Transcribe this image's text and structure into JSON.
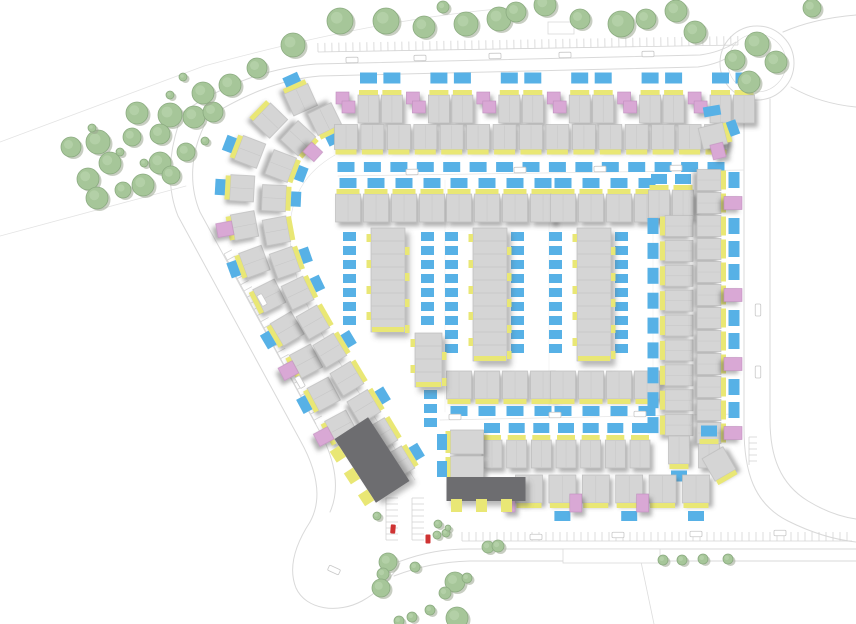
{
  "canvas": {
    "w": 856,
    "h": 624
  },
  "palette": {
    "house": "#d5d5d5",
    "houseEdge": "#bcbcbc",
    "yellow": "#e9e775",
    "blue": "#57b1e6",
    "pink": "#d9a8d5",
    "pinkEdge": "#c08fbf",
    "dark": "#6d6d6f",
    "tree": "#a6c699",
    "treeEdge": "#8bab80",
    "treeHi": "#b9d4ad",
    "treeShadow": "#9aa690",
    "road": "#d9d9d9",
    "faint": "#e6e6e6",
    "hatch": "#d4d4d4",
    "red": "#cf3333",
    "carStroke": "#c8c8c8"
  },
  "scene": {
    "roads": [
      {
        "d": "M183,112 C225,84 268,68 316,64 L700,55 C715,53 727,48 736,42"
      },
      {
        "d": "M197,124 C240,96 280,79 320,76 L698,67 C712,65 724,61 733,54"
      },
      {
        "d": "M183,112 C168,150 166,186 178,216 L300,440 C318,472 322,500 310,522"
      },
      {
        "d": "M205,124 C190,154 189,186 200,212 L320,432 C336,462 340,490 330,512"
      },
      {
        "d": "M310,522 C295,545 288,568 296,588 C306,610 338,614 362,601 C382,590 394,574 400,563"
      },
      {
        "d": "M398,562 C425,552 445,549 470,549 L856,549"
      },
      {
        "d": "M394,576 C420,566 442,562 470,561 L856,561"
      },
      {
        "d": "M744,99 L744,428 C744,472 754,504 788,521 C814,534 838,540 856,542"
      },
      {
        "d": "M770,99 L770,420 C770,456 780,484 808,501 C826,512 842,517 856,519"
      },
      {
        "d": "M783,32 C806,22 832,17 856,15"
      },
      {
        "d": "M791,87 C812,99 834,105 856,107"
      },
      {
        "d": "M0,142 L204,66",
        "w": 0.8,
        "c": "#e3e3e3"
      },
      {
        "d": "M0,236 L186,186",
        "w": 0.8,
        "c": "#e3e3e3"
      },
      {
        "d": "M204,66 C300,40 408,16 510,8",
        "w": 0.8,
        "c": "#e3e3e3"
      },
      {
        "d": "M335,155 C300,175 288,205 290,240 C292,278 310,318 338,360 L415,480",
        "w": 0.7,
        "c": "#e3e3e3"
      },
      {
        "d": "M338,176 L744,170",
        "w": 0.7,
        "c": "#e3e3e3"
      },
      {
        "d": "M440,420 L738,414",
        "w": 0.7,
        "c": "#e3e3e3"
      },
      {
        "d": "M445,180 L445,412",
        "w": 0.5,
        "c": "#ebebeb"
      },
      {
        "d": "M549,180 L549,412",
        "w": 0.5,
        "c": "#ebebeb"
      },
      {
        "d": "M653,172 L653,415",
        "w": 0.5,
        "c": "#ebebeb"
      },
      {
        "d": "M640,557 L654,624",
        "w": 0.8,
        "c": "#dddddd"
      }
    ],
    "circles": [
      {
        "cx": 757,
        "cy": 63,
        "r": 37
      },
      {
        "cx": 757,
        "cy": 63,
        "r": 29,
        "w": 0.6
      }
    ],
    "outline_rects": [
      [
        548,
        22,
        26,
        12
      ],
      [
        563,
        549,
        97,
        14
      ]
    ],
    "hatches": [
      {
        "x1": 318,
        "y1": 52,
        "x2": 738,
        "y2": 45,
        "step": 7,
        "len": 9,
        "side": 1
      },
      {
        "x1": 462,
        "y1": 541,
        "x2": 852,
        "y2": 541,
        "step": 7,
        "len": 9,
        "side": 1
      },
      {
        "x1": 224,
        "y1": 254,
        "x2": 316,
        "y2": 424,
        "step": 7,
        "len": 9,
        "side": 1
      },
      {
        "x1": 386,
        "y1": 498,
        "x2": 386,
        "y2": 540,
        "step": 6,
        "len": 12,
        "side": 1
      },
      {
        "x1": 412,
        "y1": 498,
        "x2": 412,
        "y2": 540,
        "step": 6,
        "len": 12,
        "side": 1
      },
      {
        "x1": 749,
        "y1": 437,
        "x2": 749,
        "y2": 465,
        "step": 6,
        "len": 8,
        "side": 1
      }
    ],
    "blue_cols": [
      {
        "x": 343,
        "y": 232,
        "step": 14,
        "n": 7
      },
      {
        "x": 421,
        "y": 232,
        "step": 14,
        "n": 7
      },
      {
        "x": 445,
        "y": 232,
        "step": 14,
        "n": 9
      },
      {
        "x": 511,
        "y": 232,
        "step": 14,
        "n": 9
      },
      {
        "x": 549,
        "y": 232,
        "step": 14,
        "n": 9
      },
      {
        "x": 615,
        "y": 232,
        "step": 14,
        "n": 9
      },
      {
        "x": 424,
        "y": 390,
        "step": 14,
        "n": 3
      }
    ],
    "runs": [
      {
        "name": "arc-outer-row",
        "d": "M310,96 C258,114 240,158 242,204 C244,250 268,299 299,348 L346,436",
        "n": 11,
        "pad": 10,
        "w": 26,
        "h": 24,
        "yellow": 1,
        "blue": {
          "side": 1,
          "off": 22,
          "w": 16,
          "h": 10,
          "at": [
            0,
            2,
            3,
            5,
            7,
            9
          ]
        },
        "pink": {
          "side": 1,
          "off": 20,
          "w": 14,
          "h": 16,
          "at": [
            4,
            8,
            10
          ]
        }
      },
      {
        "name": "arc-inner-row",
        "d": "M332,116 C290,132 272,170 274,210 C276,252 296,296 326,344 L402,470",
        "n": 13,
        "pad": 8,
        "w": 26,
        "h": 24,
        "yellow": -1,
        "blue": {
          "side": -1,
          "off": 22,
          "w": 15,
          "h": 10,
          "at": [
            0,
            2,
            3,
            5,
            6,
            8,
            10,
            12
          ]
        },
        "pink": {
          "side": -1,
          "off": 20,
          "w": 13,
          "h": 15,
          "at": [
            1
          ]
        }
      },
      {
        "name": "top-row-a",
        "d": "M345,109 L744,109",
        "n": 18,
        "pad": 0,
        "w": 21,
        "h": 28,
        "yellow": -1,
        "pinkSlots": 3,
        "blue": {
          "side": -1,
          "off": 31,
          "w": 17,
          "h": 11,
          "at": "all"
        }
      },
      {
        "name": "top-row-b",
        "d": "M346,137 L716,137",
        "n": 15,
        "pad": 0,
        "w": 23,
        "h": 25,
        "yellow": 1,
        "blue": {
          "side": 1,
          "off": 30,
          "w": 17,
          "h": 10,
          "at": "all"
        }
      },
      {
        "name": "block1-top-row",
        "d": "M348,208 L432,208",
        "n": 4,
        "pad": 0,
        "w": 25,
        "h": 28,
        "yellow": -1,
        "blue": {
          "side": -1,
          "off": 25,
          "w": 17,
          "h": 10,
          "at": "all"
        }
      },
      {
        "name": "block2-top-row",
        "d": "M459,208 L543,208",
        "n": 4,
        "pad": 0,
        "w": 25,
        "h": 28,
        "yellow": -1,
        "blue": {
          "side": -1,
          "off": 25,
          "w": 17,
          "h": 10,
          "at": "all"
        }
      },
      {
        "name": "block3-top-row",
        "d": "M563,208 L647,208",
        "n": 4,
        "pad": 0,
        "w": 25,
        "h": 28,
        "yellow": -1,
        "blue": {
          "side": -1,
          "off": 25,
          "w": 17,
          "h": 10,
          "at": "all"
        }
      },
      {
        "name": "block2-bottom-row",
        "d": "M459,385 L543,385",
        "n": 4,
        "pad": 0,
        "w": 25,
        "h": 28,
        "yellow": 1,
        "blue": {
          "side": 1,
          "off": 26,
          "w": 17,
          "h": 10,
          "at": "all"
        }
      },
      {
        "name": "block3-bottom-row",
        "d": "M563,385 L647,385",
        "n": 4,
        "pad": 0,
        "w": 25,
        "h": 28,
        "yellow": 1,
        "blue": {
          "side": 1,
          "off": 26,
          "w": 17,
          "h": 10,
          "at": "all"
        }
      },
      {
        "name": "east-top-pair",
        "d": "M659,204 L683,204",
        "n": 2,
        "pad": 0,
        "w": 21,
        "h": 28,
        "yellow": -1,
        "blue": {
          "side": -1,
          "off": 25,
          "w": 16,
          "h": 10,
          "at": "all"
        }
      },
      {
        "name": "east-inner-col",
        "d": "M679,226 L679,450",
        "n": 10,
        "pad": 0,
        "w": 21,
        "h": 28,
        "yellow": 1,
        "blue": {
          "side": 1,
          "off": 26,
          "w": 16,
          "h": 11,
          "at": "all"
        }
      },
      {
        "name": "east-outer-col",
        "d": "M709,180 L709,456",
        "n": 13,
        "pad": 0,
        "w": 21,
        "h": 24,
        "yellow": -1,
        "blue": {
          "side": -1,
          "off": 25,
          "w": 16,
          "h": 11,
          "at": "all"
        },
        "pink": {
          "side": -1,
          "off": 24,
          "w": 13,
          "h": 18,
          "at": [
            1,
            5,
            8,
            11
          ]
        }
      },
      {
        "name": "south-mid-row",
        "d": "M492,454 L640,454",
        "n": 7,
        "pad": 0,
        "w": 20,
        "h": 28,
        "yellow": -1,
        "blue": {
          "side": -1,
          "off": 26,
          "w": 16,
          "h": 10,
          "at": "all"
        }
      },
      {
        "name": "south-row",
        "d": "M529,489 L696,489",
        "n": 6,
        "pad": 0,
        "w": 27,
        "h": 28,
        "yellow": 1,
        "blue": {
          "side": 1,
          "off": 27,
          "w": 16,
          "h": 10,
          "at": "all"
        },
        "pink": {
          "side": 1,
          "off": 14,
          "w": 12,
          "h": 18,
          "at": [
            0,
            2,
            4
          ],
          "dx": -20
        }
      }
    ],
    "slabs": [
      {
        "x": 371,
        "y": 228,
        "w": 34,
        "h": 104
      },
      {
        "x": 415,
        "y": 333,
        "w": 27,
        "h": 54
      },
      {
        "x": 473,
        "y": 228,
        "w": 34,
        "h": 133
      },
      {
        "x": 577,
        "y": 228,
        "w": 34,
        "h": 133
      }
    ],
    "dark_buildings": [
      {
        "cx": 372,
        "cy": 460,
        "w": 40,
        "h": 76,
        "rot": -33,
        "tabs": [
          [
            -26,
            -24
          ],
          [
            -26,
            2
          ],
          [
            -26,
            28
          ]
        ]
      },
      {
        "cx": 486,
        "cy": 489,
        "w": 79,
        "h": 24,
        "rot": 0,
        "tabs": [
          [
            -30,
            16
          ],
          [
            -5,
            16
          ],
          [
            20,
            16
          ]
        ]
      }
    ],
    "extra_houses": [
      {
        "cx": 467,
        "cy": 442,
        "w": 33,
        "h": 24,
        "rot": 0,
        "yellow": "left",
        "blue": {
          "dx": -25,
          "dy": 0,
          "w": 10,
          "h": 16
        }
      },
      {
        "cx": 467,
        "cy": 467,
        "w": 33,
        "h": 22,
        "rot": 0,
        "yellow": "left",
        "blue": {
          "dx": -25,
          "dy": 2,
          "w": 10,
          "h": 16
        }
      },
      {
        "cx": 713,
        "cy": 136,
        "w": 25,
        "h": 22,
        "rot": -14,
        "yellow": "right"
      },
      {
        "cx": 719,
        "cy": 464,
        "w": 24,
        "h": 26,
        "rot": -30,
        "yellow": "bottom"
      }
    ],
    "extra_blues": [
      [
        712,
        111,
        17,
        10,
        -10
      ],
      [
        733,
        128,
        10,
        15,
        -20
      ]
    ],
    "extra_pinks": [
      [
        718,
        151,
        13,
        15,
        -14
      ]
    ],
    "cars_white": [
      [
        352,
        60,
        -1
      ],
      [
        420,
        58,
        -1
      ],
      [
        495,
        56,
        -1
      ],
      [
        565,
        55,
        -1
      ],
      [
        648,
        54,
        -1
      ],
      [
        412,
        172,
        -1
      ],
      [
        520,
        170,
        -1
      ],
      [
        600,
        169,
        -1
      ],
      [
        676,
        168,
        -1
      ],
      [
        455,
        417,
        0
      ],
      [
        555,
        415,
        0
      ],
      [
        640,
        414,
        0
      ],
      [
        536,
        537,
        0
      ],
      [
        618,
        535,
        0
      ],
      [
        696,
        534,
        0
      ],
      [
        780,
        533,
        0
      ],
      [
        758,
        310,
        90
      ],
      [
        758,
        372,
        90
      ],
      [
        262,
        300,
        60
      ],
      [
        300,
        382,
        60
      ],
      [
        334,
        570,
        25
      ]
    ],
    "cars_red": [
      [
        393,
        529,
        5
      ],
      [
        428,
        539,
        0
      ]
    ],
    "trees": [
      [
        293,
        45,
        12
      ],
      [
        340,
        21,
        13
      ],
      [
        386,
        21,
        13
      ],
      [
        424,
        27,
        11
      ],
      [
        443,
        7,
        6
      ],
      [
        466,
        24,
        12
      ],
      [
        499,
        19,
        12
      ],
      [
        516,
        12,
        10
      ],
      [
        545,
        5,
        11
      ],
      [
        580,
        19,
        10
      ],
      [
        621,
        24,
        13
      ],
      [
        646,
        19,
        10
      ],
      [
        676,
        11,
        11
      ],
      [
        695,
        32,
        11
      ],
      [
        812,
        8,
        9
      ],
      [
        757,
        44,
        12
      ],
      [
        735,
        60,
        10
      ],
      [
        776,
        62,
        11
      ],
      [
        749,
        82,
        11
      ],
      [
        137,
        113,
        11
      ],
      [
        170,
        115,
        12
      ],
      [
        194,
        117,
        11
      ],
      [
        213,
        112,
        10
      ],
      [
        98,
        142,
        12
      ],
      [
        71,
        147,
        10
      ],
      [
        132,
        137,
        9
      ],
      [
        160,
        134,
        10
      ],
      [
        110,
        163,
        11
      ],
      [
        160,
        163,
        11
      ],
      [
        186,
        152,
        9
      ],
      [
        88,
        179,
        11
      ],
      [
        143,
        185,
        11
      ],
      [
        171,
        175,
        9
      ],
      [
        97,
        198,
        11
      ],
      [
        123,
        190,
        8
      ],
      [
        92,
        128,
        4
      ],
      [
        120,
        152,
        4
      ],
      [
        144,
        163,
        4
      ],
      [
        205,
        141,
        4
      ],
      [
        230,
        85,
        11
      ],
      [
        203,
        93,
        11
      ],
      [
        257,
        68,
        10
      ],
      [
        170,
        95,
        4
      ],
      [
        183,
        77,
        4
      ],
      [
        388,
        562,
        9
      ],
      [
        383,
        574,
        6
      ],
      [
        381,
        588,
        9
      ],
      [
        437,
        535,
        4
      ],
      [
        446,
        533,
        4
      ],
      [
        415,
        567,
        5
      ],
      [
        455,
        582,
        10
      ],
      [
        467,
        578,
        5
      ],
      [
        445,
        593,
        6
      ],
      [
        430,
        610,
        5
      ],
      [
        457,
        618,
        11
      ],
      [
        412,
        617,
        5
      ],
      [
        399,
        621,
        5
      ],
      [
        488,
        547,
        6
      ],
      [
        498,
        546,
        6
      ],
      [
        663,
        560,
        5
      ],
      [
        682,
        560,
        5
      ],
      [
        703,
        559,
        5
      ],
      [
        728,
        559,
        5
      ],
      [
        377,
        516,
        4
      ],
      [
        438,
        524,
        4
      ],
      [
        448,
        528,
        3
      ]
    ]
  }
}
